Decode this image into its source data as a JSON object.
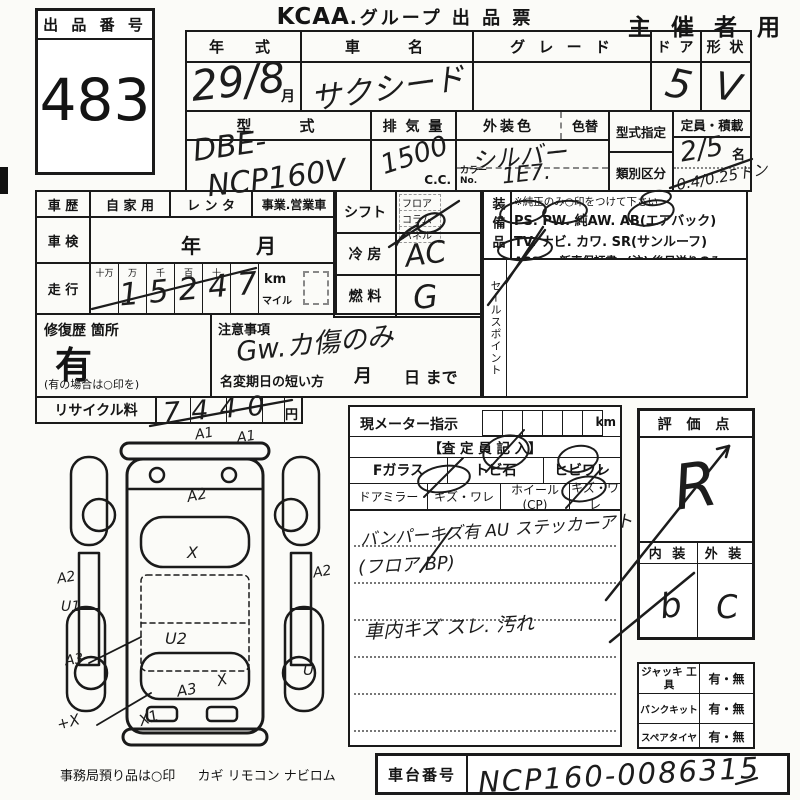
{
  "lot": {
    "header": "出 品 番 号",
    "number": "483"
  },
  "title": {
    "brand": "KCAA",
    "rest": ".グループ 出 品 票"
  },
  "organizer": {
    "label": "主 催 者 用"
  },
  "top": {
    "year": {
      "label": "年　式",
      "value": "29/8",
      "unit": "月"
    },
    "name": {
      "label": "車　　名",
      "value": "サクシード"
    },
    "grade": {
      "label": "グ レ ー ド"
    },
    "door": {
      "label": "ド ア",
      "value": "5"
    },
    "shape": {
      "label": "形 状",
      "value": "V"
    },
    "model": {
      "label": "型　　式",
      "value1": "DBE-",
      "value2": "NCP160V"
    },
    "displacement": {
      "label": "排 気 量",
      "value": "1500",
      "unit": "C.C."
    },
    "color": {
      "label": "外装色",
      "value": "シルバー",
      "recolor_label": "色替",
      "colorno_label": "カラーNo.",
      "colorno_value": "1E7."
    },
    "designation": {
      "label": "型式指定"
    },
    "classification": {
      "label": "類別区分"
    },
    "capacity": {
      "label": "定員・積載",
      "value": "2/5",
      "unit": "名",
      "load": "0.4/0.25トン"
    }
  },
  "history": {
    "label": "車 歴",
    "options": [
      "自 家 用",
      "レ ン タ",
      "事業.営業車"
    ],
    "inspection_label": "車 検",
    "inspection_year": "年",
    "inspection_month": "月",
    "mileage_label": "走 行",
    "digit_headers": [
      "十万",
      "万",
      "千",
      "百",
      "十",
      "一"
    ],
    "mileage_value": "15247",
    "km": "km",
    "mile": "マイル"
  },
  "repair": {
    "label": "修復歴 箇所",
    "value": "有",
    "note": "(有の場合は○印を)"
  },
  "caution": {
    "label": "注意事項",
    "value": "Gw.カ傷のみ",
    "rename_label": "名変期日の短い方",
    "month": "月",
    "day": "日 まで"
  },
  "shift": {
    "label": "シフト",
    "options": [
      "フロア",
      "コラム",
      "パネル"
    ]
  },
  "cooling": {
    "label": "冷 房",
    "value": "AC"
  },
  "fuel": {
    "label": "燃 料",
    "value": "G"
  },
  "equipment": {
    "label": "装備品",
    "note": "※純正のみ○印をつけて下さい",
    "line1": "PS.  PW.  純AW.  AB(エアバック)",
    "line2": "TV.  ナビ.  カワ.  SR(サンルーフ)",
    "line3": "ABS ・ 新車保証書←(注) 後日送りのみ"
  },
  "salespoint": {
    "label": "セールスポイント"
  },
  "recycle": {
    "label": "リサイクル料",
    "value": "7440",
    "unit": "円"
  },
  "meter": {
    "label": "現メーター指示",
    "unit": "km",
    "assessor": "【査 定 員 記 入】",
    "row1": [
      "Fガラス",
      "トビ石",
      "ヒビワレ"
    ],
    "row2": [
      "ドアミラー",
      "キズ・ワレ",
      "ホイール(CP)",
      "キズ・ワレ"
    ],
    "notes": [
      "バンパーキズ有 AU ステッカーアト",
      "(フロア BP)",
      "車内キズ スレ. 汚れ"
    ]
  },
  "rating": {
    "label": "評 価 点",
    "value": "R",
    "interior_label": "内 装",
    "interior_value": "b",
    "exterior_label": "外 装",
    "exterior_value": "C"
  },
  "tools": {
    "rows": [
      {
        "label": "ジャッキ 工具",
        "value": "有・無"
      },
      {
        "label": "パンクキット",
        "value": "有・無"
      },
      {
        "label": "スペアタイヤ",
        "value": "有・無"
      }
    ]
  },
  "chassis": {
    "label": "車台番号",
    "value": "NCP160-0086315"
  },
  "footer": {
    "note": "事務局預り品は○印",
    "items": "カギ  リモコン  ナビロム"
  },
  "diagram": {
    "annotations": [
      {
        "code": "A1"
      },
      {
        "code": "A1"
      },
      {
        "code": "A2"
      },
      {
        "code": "X"
      },
      {
        "code": "A2"
      },
      {
        "code": "U1"
      },
      {
        "code": "A3"
      },
      {
        "code": "U2"
      },
      {
        "code": "A2"
      },
      {
        "code": "U"
      },
      {
        "code": "A3"
      },
      {
        "code": "X"
      },
      {
        "code": "X1"
      },
      {
        "code": "+X"
      }
    ]
  }
}
